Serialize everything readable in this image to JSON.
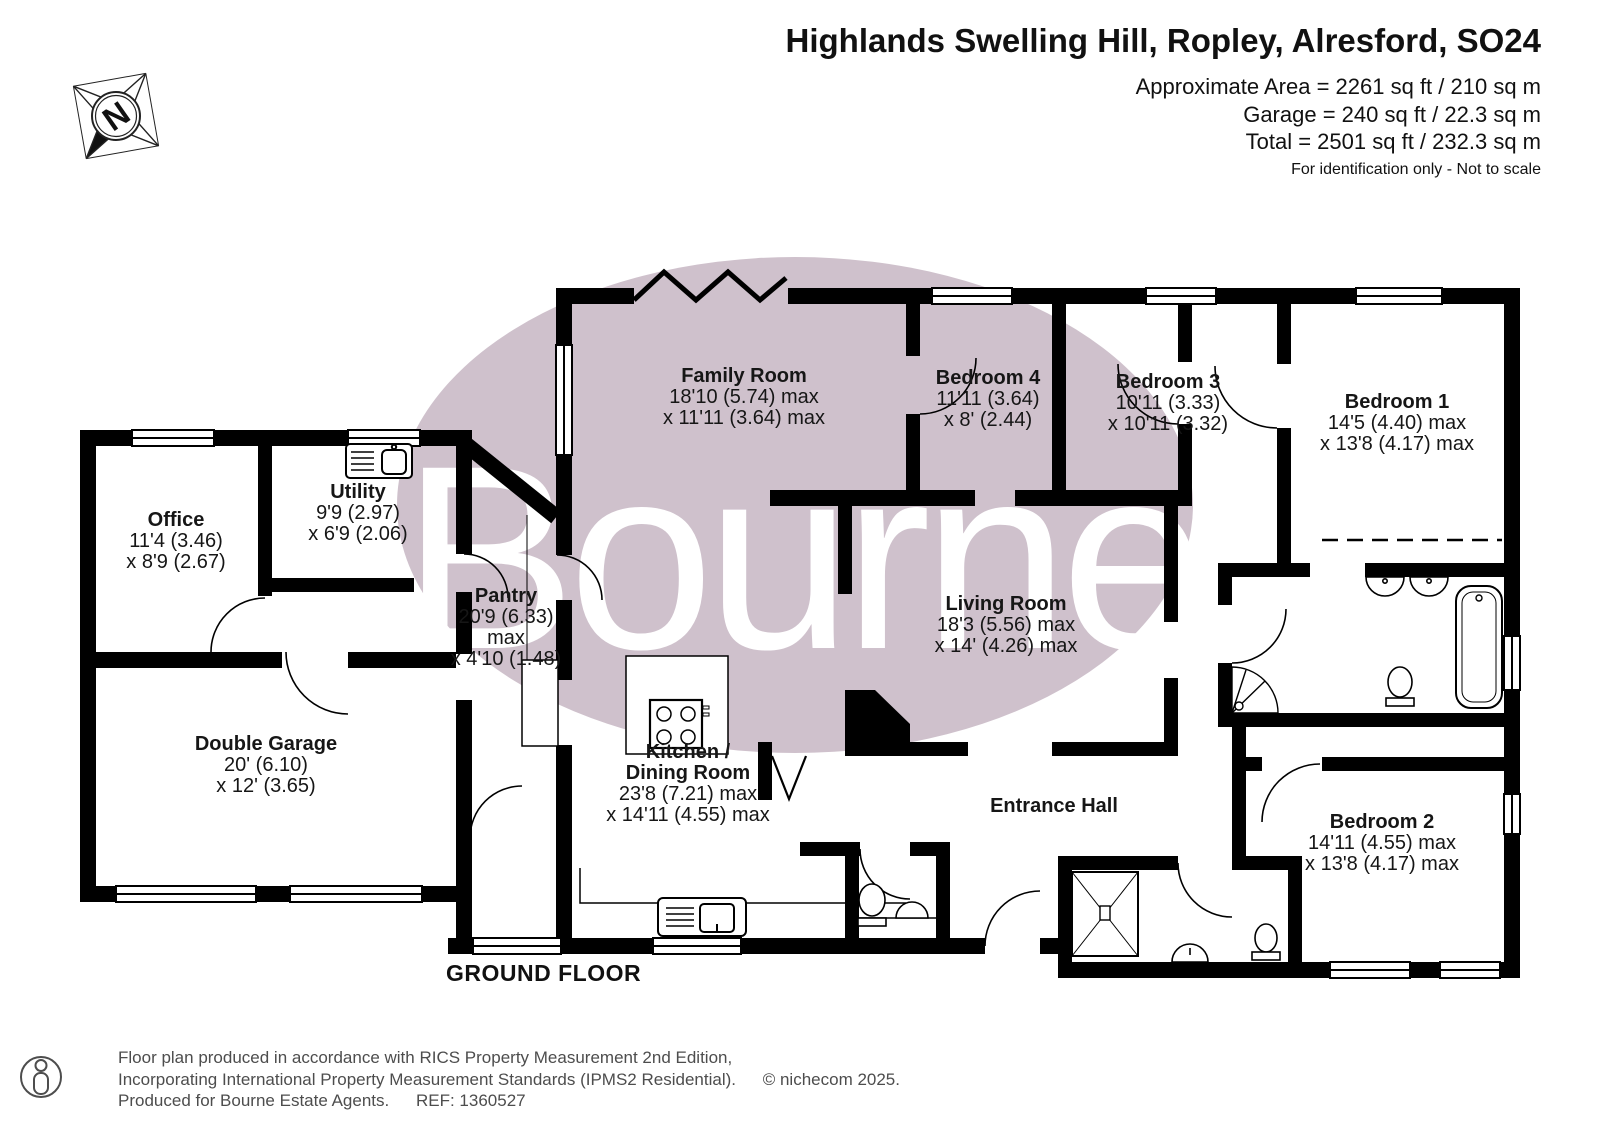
{
  "header": {
    "title": "Highlands Swelling Hill, Ropley, Alresford, SO24",
    "area": "Approximate Area = 2261 sq ft / 210 sq m",
    "garage": "Garage = 240 sq ft / 22.3 sq m",
    "total": "Total = 2501 sq ft / 232.3 sq m",
    "disclaimer": "For identification only - Not to scale"
  },
  "compass": {
    "label": "N"
  },
  "watermark": {
    "text": "Bourne",
    "ellipse_color": "#cfc1cc",
    "text_color": "#ffffff"
  },
  "plan": {
    "floor_label": "GROUND FLOOR"
  },
  "rooms": {
    "family": {
      "name": "Family Room",
      "dim1": "18'10 (5.74) max",
      "dim2": "x 11'11 (3.64) max"
    },
    "bedroom4": {
      "name": "Bedroom 4",
      "dim1": "11'11 (3.64)",
      "dim2": "x 8' (2.44)"
    },
    "bedroom3": {
      "name": "Bedroom 3",
      "dim1": "10'11 (3.33)",
      "dim2": "x 10'11 (3.32)"
    },
    "bedroom1": {
      "name": "Bedroom 1",
      "dim1": "14'5 (4.40) max",
      "dim2": "x 13'8 (4.17) max"
    },
    "office": {
      "name": "Office",
      "dim1": "11'4 (3.46)",
      "dim2": "x 8'9 (2.67)"
    },
    "utility": {
      "name": "Utility",
      "dim1": "9'9 (2.97)",
      "dim2": "x 6'9 (2.06)"
    },
    "pantry": {
      "name": "Pantry",
      "dim1": "20'9 (6.33)",
      "dim2": "max",
      "dim3": "x 4'10 (1.48)"
    },
    "living": {
      "name": "Living Room",
      "dim1": "18'3 (5.56) max",
      "dim2": "x 14' (4.26) max"
    },
    "garage": {
      "name": "Double Garage",
      "dim1": "20' (6.10)",
      "dim2": "x 12' (3.65)"
    },
    "kitchen": {
      "name": "Kitchen /",
      "name2": "Dining Room",
      "dim1": "23'8 (7.21) max",
      "dim2": "x 14'11 (4.55) max"
    },
    "entrance": {
      "name": "Entrance Hall"
    },
    "bedroom2": {
      "name": "Bedroom 2",
      "dim1": "14'11 (4.55) max",
      "dim2": "x 13'8 (4.17) max"
    }
  },
  "footer": {
    "line1": "Floor plan produced in accordance with RICS Property Measurement 2nd Edition,",
    "line2": "Incorporating International Property Measurement Standards (IPMS2 Residential).",
    "copyright": "© nichecom 2025.",
    "produced": "Produced for Bourne Estate Agents.",
    "ref": "REF:  1360527"
  }
}
